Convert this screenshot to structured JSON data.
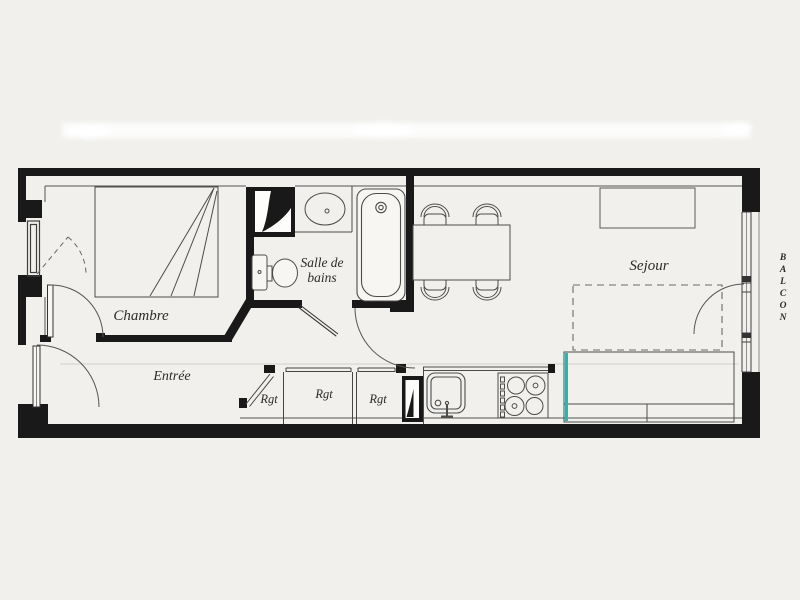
{
  "plan": {
    "title": "apartment-floor-plan-scan",
    "colors": {
      "background": "#f1f0ed",
      "wall": "#191919",
      "furniture_line": "#4c4c4c",
      "accent_teal": "#2fb3ad",
      "smudge_white": "#ffffff"
    },
    "labels": {
      "chambre": "Chambre",
      "entree": "Entrée",
      "salle_line1": "Salle de",
      "salle_line2": "bains",
      "sejour": "Sejour",
      "balcon": "BALCON",
      "rgt1": "Rgt",
      "rgt2": "Rgt",
      "rgt3": "Rgt"
    }
  }
}
